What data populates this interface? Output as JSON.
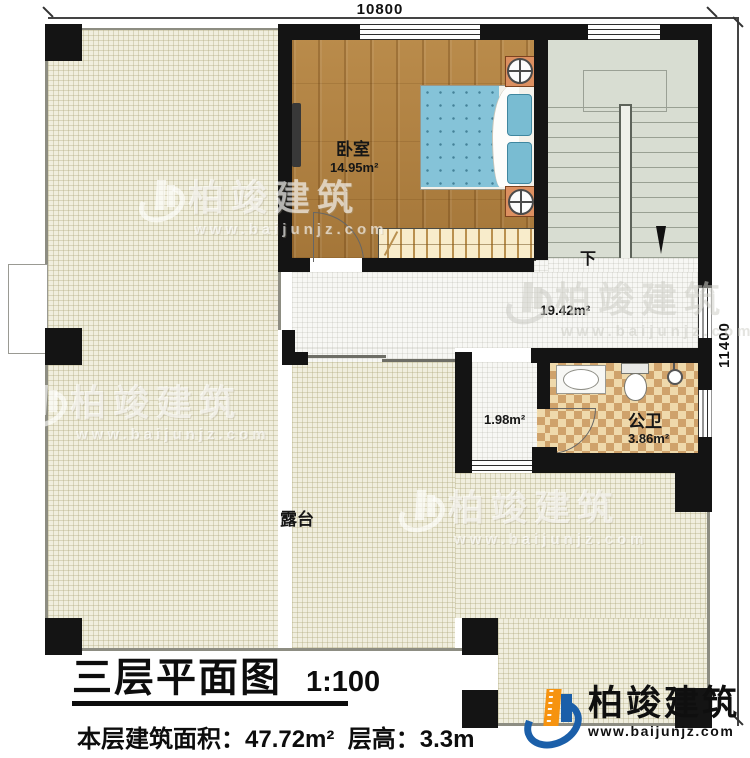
{
  "dimensions": {
    "top": "10800",
    "right": "11400"
  },
  "rooms": {
    "bedroom": {
      "label": "卧室",
      "area": "14.95m²"
    },
    "hall": {
      "area": "19.42m²"
    },
    "corridor": {
      "area": "1.98m²"
    },
    "bathroom": {
      "label": "公卫",
      "area": "3.86m²"
    },
    "terrace": {
      "label": "露台"
    },
    "stairs": {
      "down_label": "下"
    }
  },
  "title_block": {
    "title": "三层平面图",
    "scale": "1:100",
    "info": "本层建筑面积：47.72m²  层高：3.3m"
  },
  "branding": {
    "name": "柏竣建筑",
    "url": "www.baijunjz.com"
  },
  "watermark": {
    "name": "柏竣建筑",
    "url": "www.baijunjz.com"
  },
  "colors": {
    "wall": "#141414",
    "terrace": "#f0eede",
    "wood": "#b0803f",
    "stair": "#d8ddd2",
    "checker_dark": "#cfa26b",
    "bed_blue": "#85c3d8",
    "logo_blue": "#1b5fa9",
    "logo_orange": "#f6930f"
  }
}
